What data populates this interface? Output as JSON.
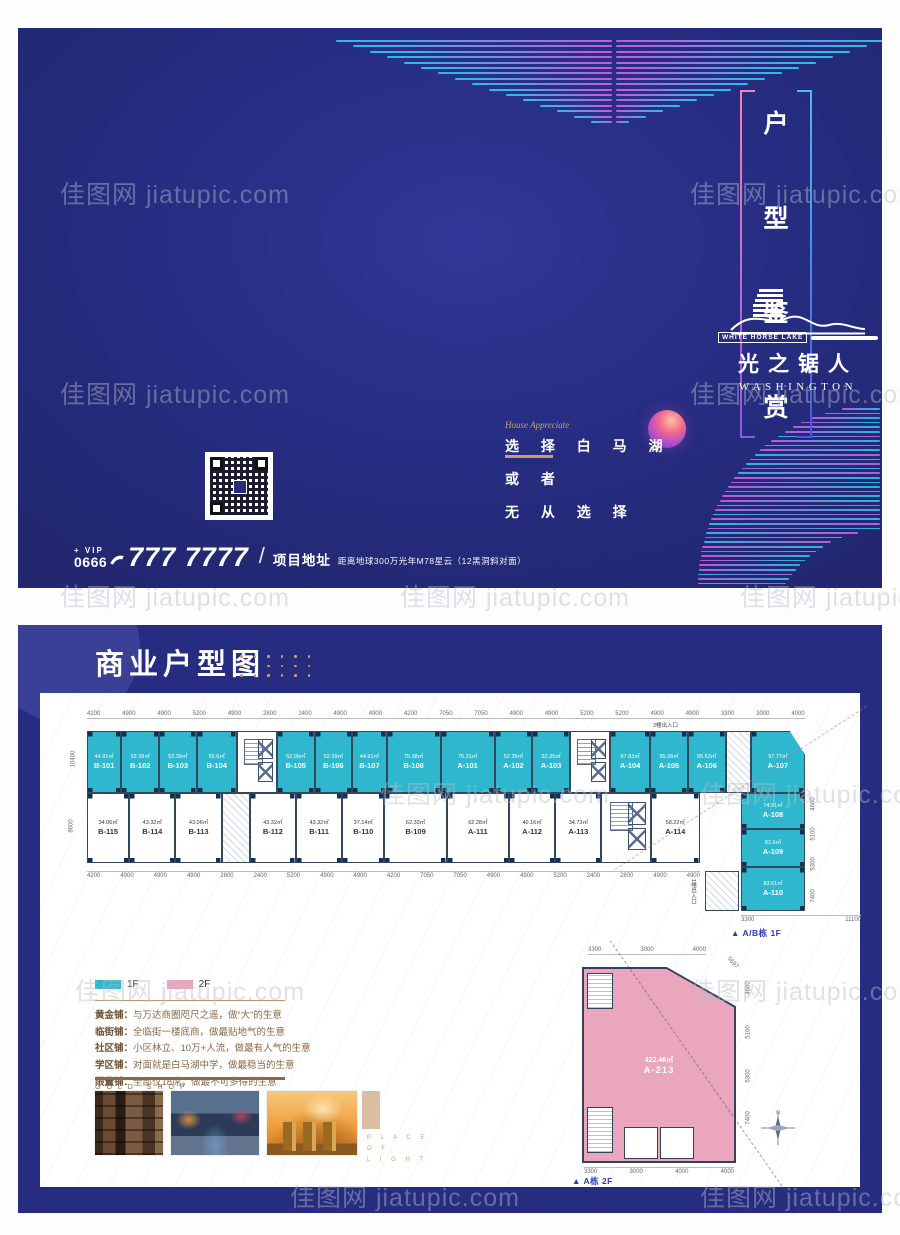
{
  "watermark": {
    "text": "佳图网 jiatupic.com"
  },
  "cover": {
    "title_vertical": [
      "户",
      "型",
      "鉴",
      "赏"
    ],
    "logo": {
      "banner": "WHITE HORSE LAKE",
      "name": "光之锯人",
      "sub": "WASHINGTON"
    },
    "script": "House Appreciate",
    "slogan": [
      "选 择 白 马 湖",
      "或 者",
      "无 从 选 择"
    ],
    "phone": {
      "plus_vip": "+ VIP",
      "code": "0666",
      "number": "777 7777",
      "divider": "/",
      "address_label": "项目地址",
      "address_text": "距离地球300万光年M78星云（12黑洞斜对面）"
    }
  },
  "panel": {
    "title": "商业户型图",
    "legend": [
      {
        "label": "1F",
        "color": "#2fb7ce"
      },
      {
        "label": "2F",
        "color": "#e9a6bc"
      }
    ],
    "shops": [
      {
        "label": "黄金铺：",
        "text": "与万达商圈咫尺之遥，做“大”的生意"
      },
      {
        "label": "临街铺：",
        "text": "全临街一楼底商，做最贴地气的生意"
      },
      {
        "label": "社区铺：",
        "text": "小区林立、10万+人流，做最有人气的生意"
      },
      {
        "label": "学区铺：",
        "text": "对面就是白马湖中学，做最稳当的生意"
      },
      {
        "label": "限量铺：",
        "text": "全部仅18席，做最不可多得的生意"
      }
    ],
    "gold_shop": "GOLD SHOP",
    "place_of_light": [
      "P L A C E",
      "O F",
      "L I G H T"
    ],
    "plan1f": {
      "caption": "▲ A/B栋 1F",
      "entrance_top": "2幢出入口",
      "entrance_side": "1幢出入口",
      "top_units": [
        {
          "t": "u",
          "id": "B-101",
          "area": "44.91㎡",
          "w": 42
        },
        {
          "t": "u",
          "id": "B-102",
          "area": "52.39㎡",
          "w": 46
        },
        {
          "t": "u",
          "id": "B-103",
          "area": "52.39㎡",
          "w": 46
        },
        {
          "t": "u",
          "id": "B-104",
          "area": "55.6㎡",
          "w": 49
        },
        {
          "t": "core",
          "w": 49
        },
        {
          "t": "u",
          "id": "B-105",
          "area": "52.09㎡",
          "w": 46
        },
        {
          "t": "u",
          "id": "B-106",
          "area": "52.39㎡",
          "w": 46
        },
        {
          "t": "u",
          "id": "B-107",
          "area": "44.91㎡",
          "w": 42
        },
        {
          "t": "u",
          "id": "B-108",
          "area": "75.38㎡",
          "w": 66
        },
        {
          "t": "u",
          "id": "A-101",
          "area": "75.31㎡",
          "w": 66
        },
        {
          "t": "u",
          "id": "A-102",
          "area": "52.35㎡",
          "w": 46
        },
        {
          "t": "u",
          "id": "A-103",
          "area": "52.35㎡",
          "w": 46
        },
        {
          "t": "core",
          "w": 49
        },
        {
          "t": "u",
          "id": "A-104",
          "area": "67.83㎡",
          "w": 49
        },
        {
          "t": "u",
          "id": "A-105",
          "area": "95.36㎡",
          "w": 46
        },
        {
          "t": "u",
          "id": "A-106",
          "area": "95.63㎡",
          "w": 46
        },
        {
          "t": "stair",
          "w": 31
        },
        {
          "t": "u",
          "id": "A-107",
          "area": "97.77㎡",
          "w": 66,
          "clip": true
        }
      ],
      "bottom_units": [
        {
          "t": "u",
          "id": "B-115",
          "area": "34.06㎡",
          "w": 42
        },
        {
          "t": "u",
          "id": "B-114",
          "area": "43.32㎡",
          "w": 46
        },
        {
          "t": "u",
          "id": "B-113",
          "area": "43.06㎡",
          "w": 46
        },
        {
          "t": "stair",
          "w": 28
        },
        {
          "t": "u",
          "id": "B-112",
          "area": "43.32㎡",
          "w": 46
        },
        {
          "t": "u",
          "id": "B-111",
          "area": "43.32㎡",
          "w": 46
        },
        {
          "t": "u",
          "id": "B-110",
          "area": "37.14㎡",
          "w": 42
        },
        {
          "t": "u",
          "id": "B-109",
          "area": "62.33㎡",
          "w": 62
        },
        {
          "t": "u",
          "id": "A-111",
          "area": "62.28㎡",
          "w": 62
        },
        {
          "t": "u",
          "id": "A-112",
          "area": "40.16㎡",
          "w": 46
        },
        {
          "t": "u",
          "id": "A-113",
          "area": "34.73㎡",
          "w": 46
        },
        {
          "t": "core",
          "w": 49
        },
        {
          "t": "u",
          "id": "A-114",
          "area": "58.22㎡",
          "w": 49
        }
      ],
      "wing_units": [
        {
          "id": "A-108",
          "area": "74.91㎡",
          "h": 36
        },
        {
          "id": "A-109",
          "area": "82.6㎡",
          "h": 38
        },
        {
          "id": "A-110",
          "area": "83.61㎡",
          "h": 44
        }
      ],
      "dims_top": [
        "4200",
        "4900",
        "4900",
        "5200",
        "4900",
        "2800",
        "2400",
        "4900",
        "4900",
        "4200",
        "7050",
        "7050",
        "4900",
        "4900",
        "5200",
        "5200",
        "4900",
        "4900",
        "3300",
        "3000",
        "4000"
      ],
      "dims_bottom": [
        "4200",
        "4900",
        "4900",
        "4900",
        "2800",
        "2400",
        "5200",
        "4900",
        "4900",
        "4200",
        "7050",
        "7050",
        "4900",
        "4900",
        "5200",
        "2400",
        "2800",
        "4900",
        "4900"
      ],
      "dims_left": [
        "10400",
        "8600"
      ],
      "dims_right": [
        "4600",
        "5100",
        "5300",
        "7400"
      ],
      "dims_bottom_right": [
        "3300",
        "11100"
      ]
    },
    "plan2f": {
      "caption": "▲ A栋 2F",
      "unit": {
        "id": "A-213",
        "area": "422.46㎡"
      },
      "dims_top": [
        "3300",
        "3000",
        "4000"
      ],
      "dim_slant": "5697",
      "dims_right": [
        "4600",
        "5100",
        "5300",
        "7400"
      ],
      "dims_bottom": [
        "3300",
        "3000",
        "4000",
        "4000"
      ],
      "compass_n": "N"
    }
  }
}
